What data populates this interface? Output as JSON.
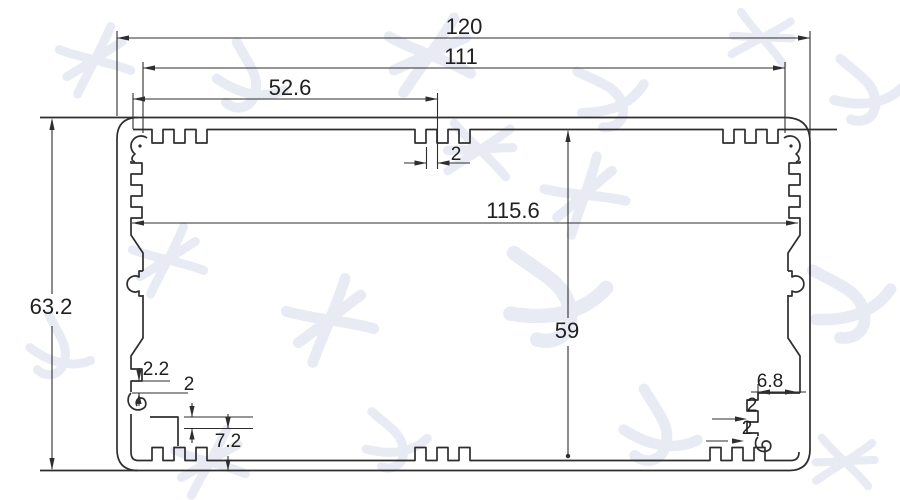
{
  "drawing": {
    "description": "Aluminium extrusion enclosure profile cross-section with dimensions",
    "dims": {
      "overall_width": "120",
      "boss_spacing": "111",
      "groove_offset": "52.6",
      "top_rib_width": "2",
      "inner_width": "115.6",
      "inner_height": "59",
      "overall_height": "63.2",
      "bl_wall_thickness": "2.2",
      "bl_step": "2",
      "bl_step_height": "7.2",
      "br_boss_width": "6.8",
      "br_rib_1": "2",
      "br_rib_2": "2"
    },
    "colors": {
      "line": "#2e2e2e",
      "text": "#1f1f1f",
      "watermark": "#e8ebf4",
      "background": "#ffffff"
    }
  }
}
